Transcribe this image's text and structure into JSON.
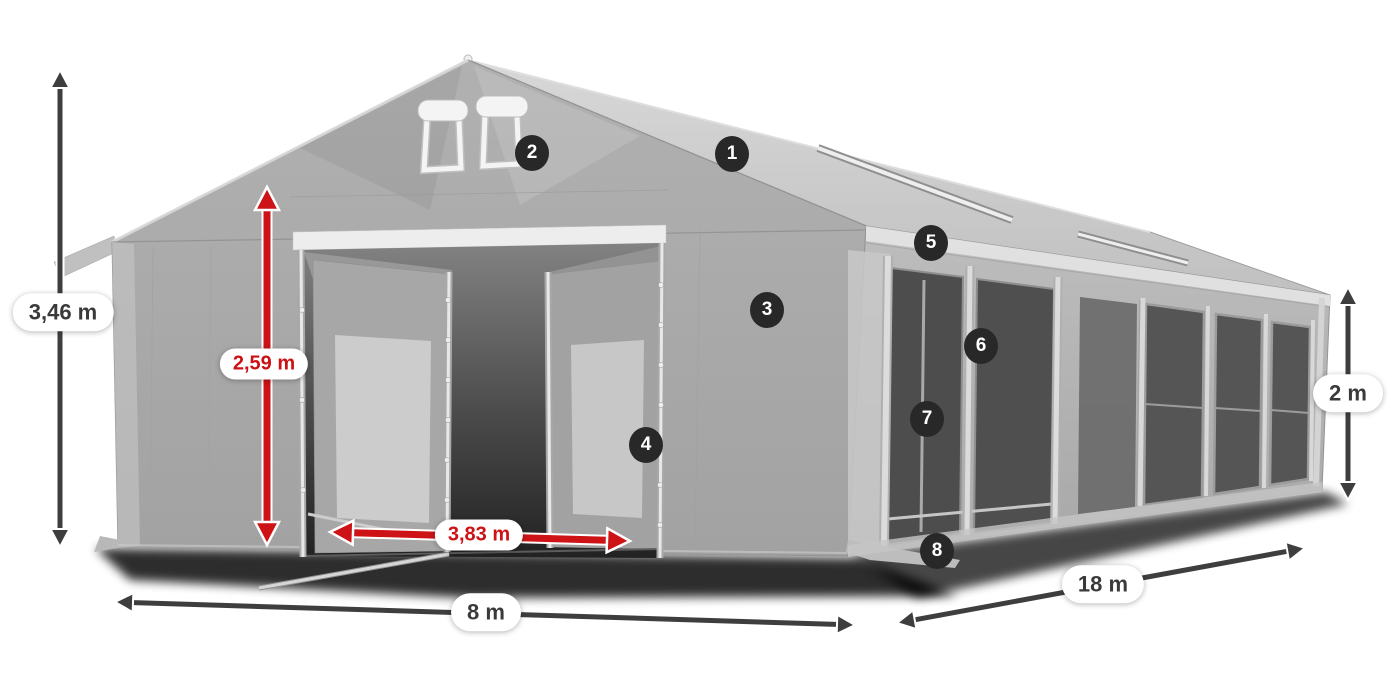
{
  "colors": {
    "background": "#ffffff",
    "dimension_arrow_dark": "#3e3e3e",
    "dimension_arrow_red": "#cd1316",
    "label_text_dark": "#3a3a3a",
    "label_text_red": "#cc1117",
    "marker_background": "#282828",
    "marker_text": "#ffffff"
  },
  "dimension_labels": [
    {
      "id": "total-height",
      "text": "3,46 m",
      "style": "dark"
    },
    {
      "id": "entrance-height",
      "text": "2,59 m",
      "style": "red"
    },
    {
      "id": "entrance-width",
      "text": "3,83 m",
      "style": "red"
    },
    {
      "id": "front-width",
      "text": "8 m",
      "style": "dark"
    },
    {
      "id": "side-length",
      "text": "18 m",
      "style": "dark"
    },
    {
      "id": "side-height",
      "text": "2 m",
      "style": "dark"
    }
  ],
  "feature_markers": [
    {
      "number": "1"
    },
    {
      "number": "2"
    },
    {
      "number": "3"
    },
    {
      "number": "4"
    },
    {
      "number": "5"
    },
    {
      "number": "6"
    },
    {
      "number": "7"
    },
    {
      "number": "8"
    }
  ]
}
